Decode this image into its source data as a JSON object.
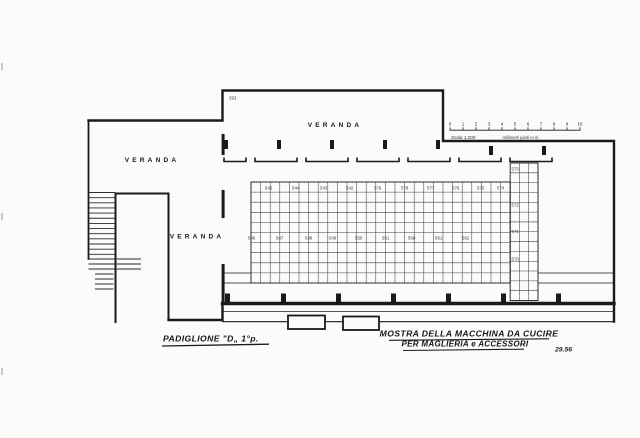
{
  "page": {
    "paper_color": "#fbfbf9",
    "ink_color": "#1a1a1a",
    "grid_color": "#3f3f3f"
  },
  "plan": {
    "veranda_labels": {
      "top": "VERANDA",
      "left": "VERANDA",
      "lower": "VERANDA"
    },
    "room_number": "393",
    "stands": {
      "top_row": [
        "545",
        "544",
        "543",
        "542",
        "579",
        "578",
        "577",
        "576",
        "575",
        "574"
      ],
      "bottom_row": [
        "546",
        "547",
        "548",
        "549",
        "550",
        "551",
        "560",
        "561",
        "562"
      ],
      "right_column": [
        "573",
        "572",
        "571",
        "570"
      ]
    }
  },
  "scale_bar": {
    "ticks": [
      "0",
      "1",
      "2",
      "3",
      "4",
      "5",
      "6",
      "7",
      "8",
      "9",
      "10"
    ],
    "label": "Scala 1:200",
    "units_label": "millimetri piedi m.m."
  },
  "titles": {
    "pavilion": "PADIGLIONE \"D„ 1°p.",
    "exhibition_line1": "MOSTRA DELLA MACCHINA DA CUCIRE",
    "exhibition_line2": "PER MAGLIERIA e ACCESSORI",
    "sheet_number": "29.56"
  }
}
